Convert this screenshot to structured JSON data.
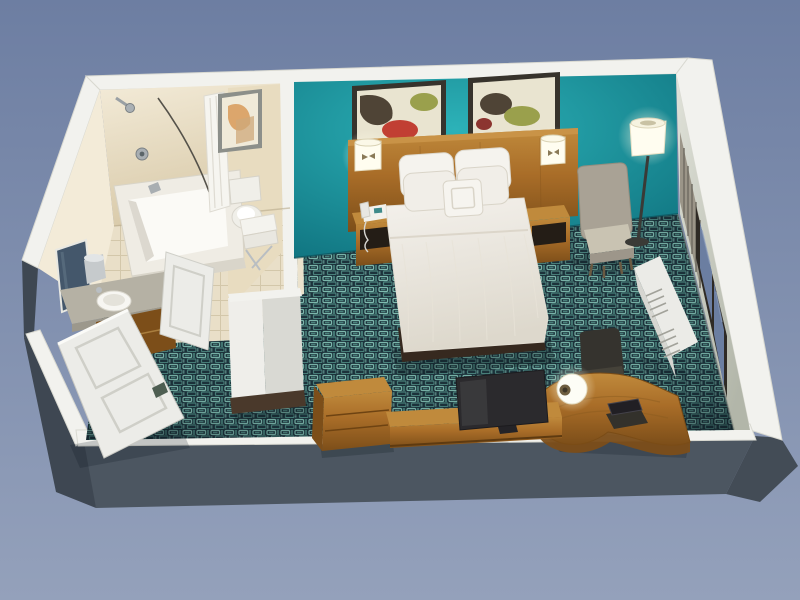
{
  "scene": {
    "label": "3D cutaway floor plan render of a hotel guest room with bathroom, queen bed and work desk",
    "view": "isometric top-down cutaway",
    "rooms": [
      {
        "name": "bathroom",
        "fixtures": [
          "bathtub",
          "shower-head",
          "shower-curtain",
          "framed-art",
          "toilet",
          "towel-rack",
          "vanity-sink",
          "mirror",
          "ice-bucket",
          "bathroom-door"
        ]
      },
      {
        "name": "bedroom",
        "fixtures": [
          "accent-wall",
          "artwork-left",
          "artwork-right",
          "headboard",
          "wall-sconce-left",
          "wall-sconce-right",
          "nightstand-left",
          "nightstand-right",
          "telephone",
          "queen-bed",
          "armchair",
          "floor-lamp",
          "window",
          "louver-panel",
          "ac-unit",
          "office-chair",
          "work-desk",
          "desk-lamp",
          "laptop",
          "luggage-chest",
          "tv-console",
          "television",
          "closet-column",
          "entry-door"
        ]
      }
    ]
  },
  "palette": {
    "bg_top": "#6d7ea2",
    "bg_bottom": "#94a1bb",
    "band": "#f2f2ee",
    "band_edge": "#d8d8d0",
    "ext_south": "#4c5661",
    "ext_west": "#3e4752",
    "ext_corner": "#434c56",
    "teal_light": "#2cb2b8",
    "teal_dark": "#0c6b78",
    "bath_wall_light": "#f3ebd8",
    "bath_wall": "#e8dcc0",
    "bath_wall_dark": "#d8c9a8",
    "partition_cream": "#ebe2cc",
    "column_light": "#efeeea",
    "column_shade": "#d9d9d3",
    "column_base": "#4a392b",
    "tile": "#e9dfc8",
    "tile_line": "#d3c7aa",
    "carpet_bg": "#1d343d",
    "carpet_teal": "#7fbcb0",
    "carpet_mid": "#4d8680",
    "wood_light": "#c08a3c",
    "wood": "#a96d28",
    "wood_dark": "#7c4e19",
    "bed_light": "#f4f1ec",
    "bed_shadow": "#ddd8cc",
    "bed_base": "#36291f",
    "pillow": "#f5f3ee",
    "armchair": "#a9a295",
    "armchair_seat": "#c9c3b2",
    "office_chair": "#35332e",
    "tv": "#2b2a2d",
    "lamp": "#fffdf0",
    "glass": "#6b7ea1",
    "frame_dark": "#2e2a25",
    "east_wall_light": "#e0e2d9",
    "east_wall_dark": "#b2b6a9",
    "ac": "#ebebe7",
    "ac_side": "#d6d6d1",
    "door": "#ecece8",
    "door_line": "#cfcfc8",
    "metal": "#b9bec2",
    "mirror": "#44576b",
    "toilet": "#f0efe9",
    "phone": "#f2f1ec",
    "art_red": "#c13f33",
    "art_olive": "#9aa04c",
    "art_dark": "#4f4436",
    "art_cream": "#e9e4d0",
    "art_rust": "#d89a58",
    "shadow": "#0a161c"
  }
}
